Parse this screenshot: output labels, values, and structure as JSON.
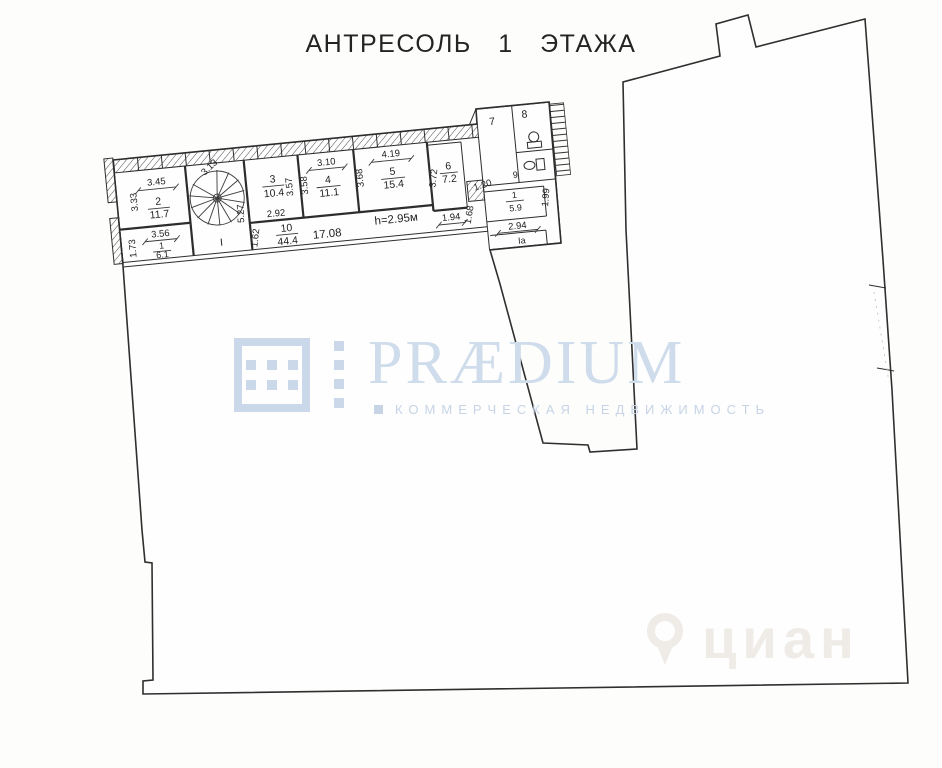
{
  "title": "АНТРЕСОЛЬ 1 ЭТАЖА",
  "plan": {
    "stair_space_label": "I",
    "stair_dim": "3.13",
    "rooms": {
      "r2": {
        "number": "2",
        "area": "11.7"
      },
      "r1l": {
        "number": "1",
        "area": "6.1"
      },
      "r3": {
        "number": "3",
        "area": "10.4"
      },
      "r4": {
        "number": "4",
        "area": "11.1"
      },
      "r5": {
        "number": "5",
        "area": "15.4"
      },
      "r6": {
        "number": "6",
        "area": "7.2"
      },
      "r7": {
        "number": "7"
      },
      "r8": {
        "number": "8"
      },
      "r9": {
        "number": "9"
      },
      "r10": {
        "number": "10",
        "area": "44.4"
      },
      "r1r": {
        "number": "1",
        "area": "5.9"
      },
      "r1a": {
        "number": "Iа"
      }
    },
    "dims": {
      "w345": "3.45",
      "v333": "3.33",
      "w356": "3.56",
      "v173": "1.73",
      "v527": "5.27",
      "w292": "2.92",
      "v357": "3.57",
      "v358": "3.58",
      "w310": "3.10",
      "v368": "3.68",
      "w419": "4.19",
      "v372": "3.72",
      "w194": "1.94",
      "v120": "1.20",
      "v162": "1.62",
      "w1708": "17.08",
      "height_note": "h=2.95м",
      "v168": "1.68",
      "v199": "1.99",
      "w294": "2.94"
    }
  },
  "watermark": {
    "brand": "PRÆDIUM",
    "tagline": "КОММЕРЧЕСКАЯ НЕДВИЖИМОСТЬ",
    "photo_stamp": "циан",
    "accent_color": "#ccd9ea"
  }
}
